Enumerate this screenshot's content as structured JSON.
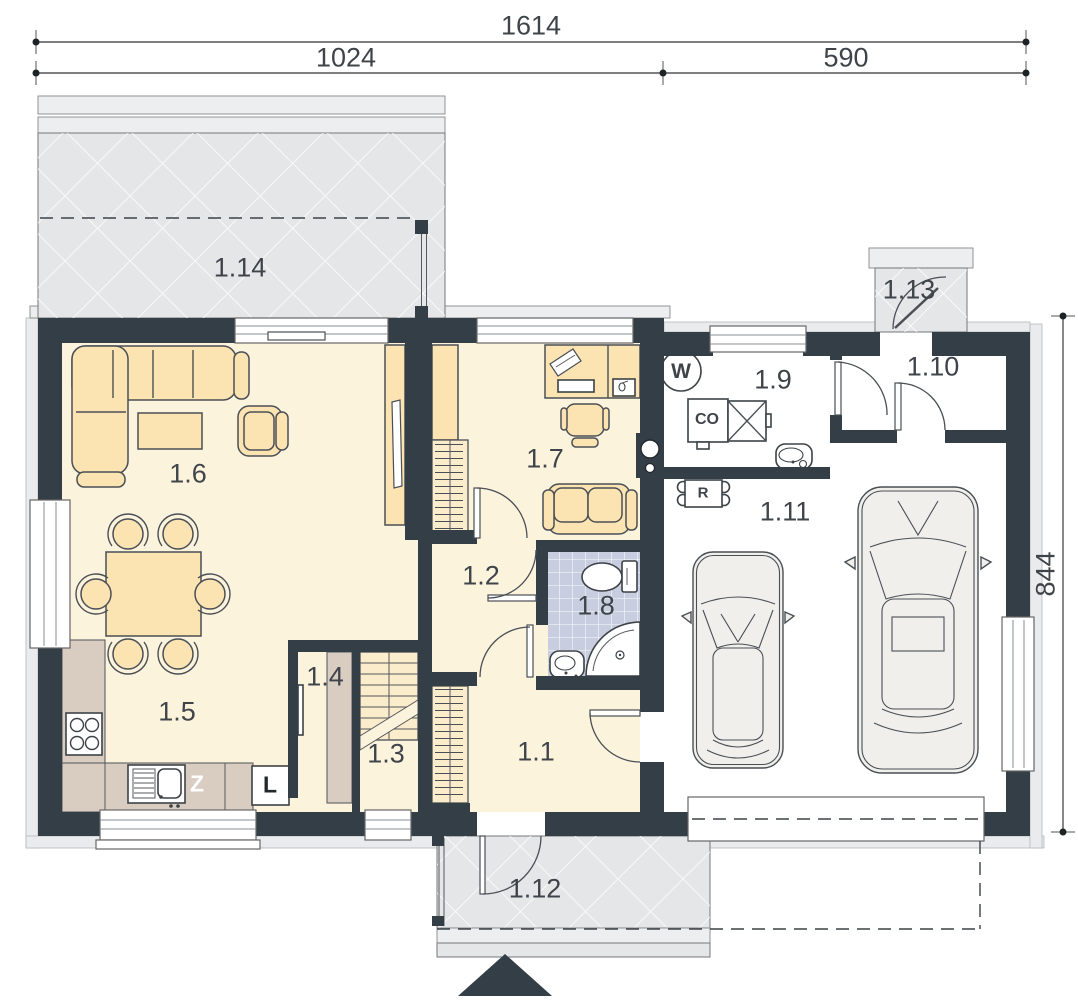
{
  "dimensions": {
    "overall_width": "1614",
    "width_left": "1024",
    "width_right": "590",
    "height_right": "844"
  },
  "rooms": {
    "r1_1": {
      "label": "1.1"
    },
    "r1_2": {
      "label": "1.2"
    },
    "r1_3": {
      "label": "1.3"
    },
    "r1_4": {
      "label": "1.4"
    },
    "r1_5": {
      "label": "1.5"
    },
    "r1_6": {
      "label": "1.6"
    },
    "r1_7": {
      "label": "1.7"
    },
    "r1_8": {
      "label": "1.8"
    },
    "r1_9": {
      "label": "1.9"
    },
    "r1_10": {
      "label": "1.10"
    },
    "r1_11": {
      "label": "1.11"
    },
    "r1_12": {
      "label": "1.12"
    },
    "r1_13": {
      "label": "1.13"
    },
    "r1_14": {
      "label": "1.14"
    }
  },
  "equipment": {
    "water_heater": "W",
    "boiler": "CO",
    "distributor": "R",
    "dishwasher": "Z",
    "fridge": "L"
  },
  "colors": {
    "wall": "#333e46",
    "floor": "#fcf3dd",
    "furniture": "#fbe3b2",
    "furniture_light": "#fbeccc",
    "counter": "#d9cdc1",
    "tile": "#c9cde0",
    "paving": "#e4e6e8",
    "paving_light": "#edeef0",
    "car_body": "#f0efec",
    "ink": "#3f444a",
    "dim": "#4a4f55"
  }
}
